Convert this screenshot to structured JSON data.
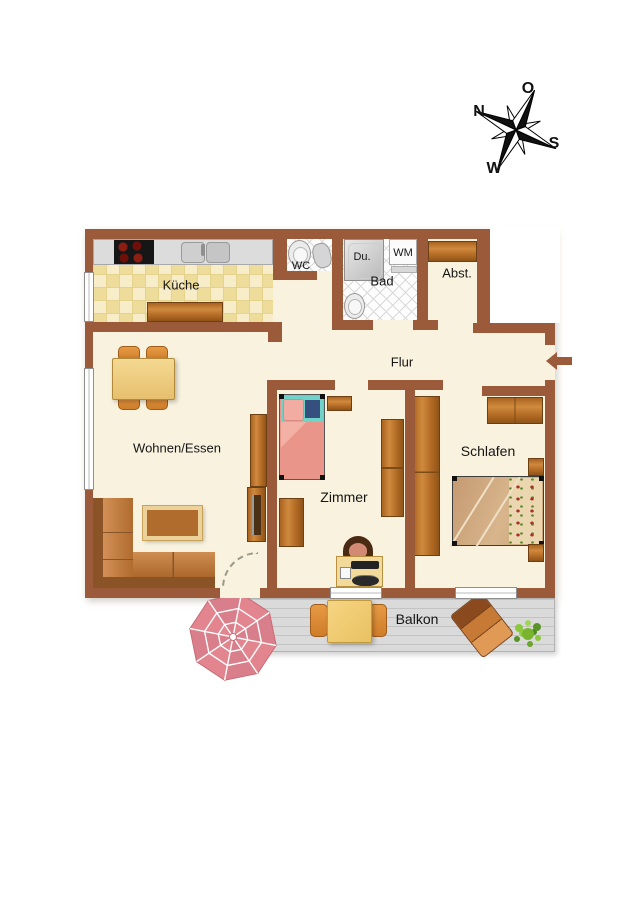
{
  "compass": {
    "n": "N",
    "o": "O",
    "s": "S",
    "w": "W"
  },
  "rooms": {
    "kueche": "Küche",
    "wc": "WC",
    "dusche": "Du.",
    "bad": "Bad",
    "wm": "WM",
    "abst": "Abst.",
    "flur": "Flur",
    "wohnen": "Wohnen/Essen",
    "zimmer": "Zimmer",
    "schlafen": "Schlafen",
    "balkon": "Balkon"
  },
  "colors": {
    "wall_brown": "#9b5b3b",
    "floor_cream": "#f9f2df",
    "kitchen_tile_yellow": "#f3e6ae",
    "bathroom_tile_white": "#fdfdfd",
    "wood_orange": "#b26a24",
    "sofa_brown": "#c98243",
    "parasol_pink": "#e2858f",
    "deck_gray": "#dadada",
    "bed_salmon": "#e99184",
    "bed_teal": "#6fd3ca",
    "bed_tan": "#c59a72",
    "chair_orange": "#dd8d36",
    "plant_green": "#7ab42e",
    "entrance_arrow_brown": "#9b5b3b"
  }
}
